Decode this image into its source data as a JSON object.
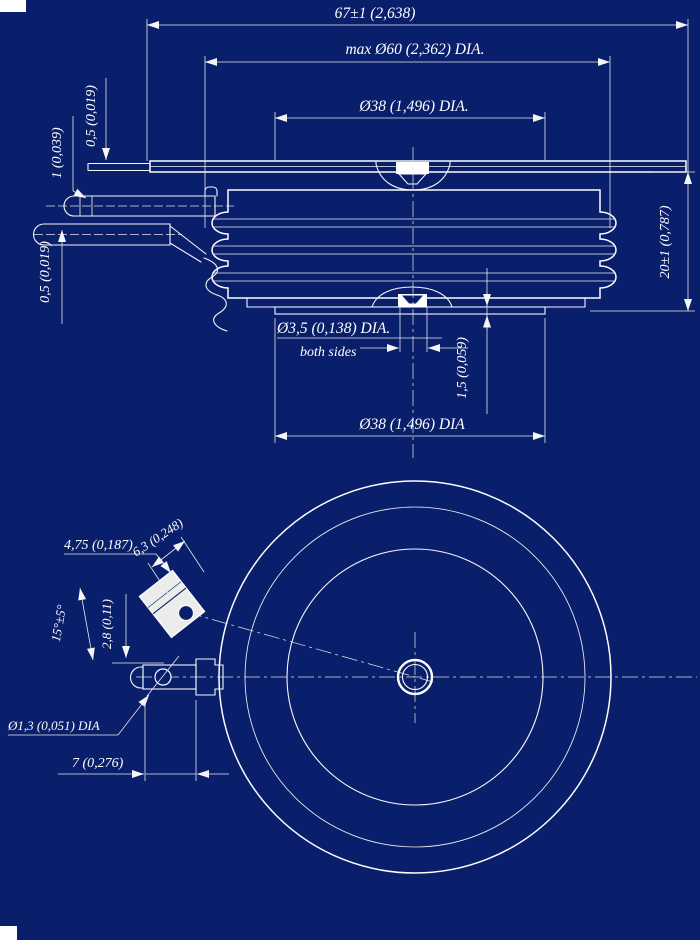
{
  "colors": {
    "background": "#0a1f6b",
    "line": "#ffffff"
  },
  "side_view": {
    "dim_overall_width": "67±1 (2,638)",
    "dim_max_diameter": "max Ø60 (2,362) DIA.",
    "dim_top_pole_diameter": "Ø38 (1,496) DIA.",
    "dim_lead_thickness_upper": "0,5 (0,019)",
    "dim_lead_spacing": "1 (0,039)",
    "dim_lead_thickness_lower": "0,5 (0,019)",
    "dim_height": "20±1 (0,787)",
    "dim_gate_hole": "Ø3,5 (0,138) DIA.",
    "gate_hole_note": "both sides",
    "dim_recess_depth": "1,5 (0,059)",
    "dim_bottom_pole_diameter": "Ø38 (1,496) DIA"
  },
  "plan_view": {
    "dim_tab_width": "6,3 (0,248)",
    "dim_tab_length": "4,75 (0,187)",
    "dim_tab_angle": "15°±5°",
    "dim_terminal_offset": "2,8 (0,11)",
    "dim_terminal_hole": "Ø1,3 (0,051) DIA",
    "dim_terminal_length": "7 (0,276)"
  }
}
